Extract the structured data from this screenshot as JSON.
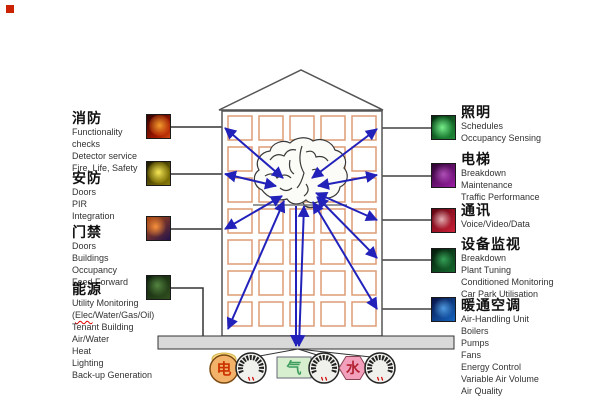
{
  "colors": {
    "arrow": "#2222bb",
    "window_frame": "#dd9c74",
    "corner_mark": "#cc2200"
  },
  "left_sections": [
    {
      "key": "fire",
      "icon": "fire-icon",
      "title": "消防",
      "lines": [
        "Functionality",
        "checks",
        "Detector service",
        "Fire, Life, Safety"
      ]
    },
    {
      "key": "security",
      "icon": "security-icon",
      "title": "安防",
      "lines": [
        "Doors",
        "PIR",
        "Integration"
      ]
    },
    {
      "key": "access",
      "icon": "access-control-icon",
      "title": "门禁",
      "lines": [
        "Doors",
        "Buildings",
        "Occupancy",
        "Feed Forward"
      ]
    },
    {
      "key": "energy",
      "icon": "energy-icon",
      "title": "能源",
      "squiggle_word": "Elec",
      "lines": [
        "Utility Monitoring",
        "(Elec/Water/Gas/Oil)",
        "Tenant Building",
        "Air/Water",
        "Heat",
        "Lighting",
        "Back-up Generation"
      ]
    }
  ],
  "right_sections": [
    {
      "key": "lighting",
      "icon": "lighting-icon",
      "title": "照明",
      "lines": [
        "Schedules",
        "Occupancy Sensing"
      ]
    },
    {
      "key": "elevator",
      "icon": "elevator-icon",
      "title": "电梯",
      "lines": [
        "Breakdown",
        "Maintenance",
        "Traffic Performance"
      ]
    },
    {
      "key": "comms",
      "icon": "communications-icon",
      "title": "通讯",
      "lines": [
        "Voice/Video/Data"
      ]
    },
    {
      "key": "monitor",
      "icon": "equipment-monitoring-icon",
      "title": "设备监视",
      "lines": [
        "Breakdown",
        "Plant Tuning",
        "Conditioned Monitoring",
        "Car Park Utilisation"
      ]
    },
    {
      "key": "hvac",
      "icon": "hvac-icon",
      "title": "暖通空调",
      "lines": [
        "Air-Handling Unit",
        "Boilers",
        "Pumps",
        "Fans",
        "Energy Control",
        "Variable Air Volume",
        "Air Quality"
      ]
    }
  ],
  "meters": [
    {
      "label": "电",
      "icon": "electricity-meter-icon",
      "shape": "circle"
    },
    {
      "label": "气",
      "icon": "gas-meter-icon",
      "shape": "rect"
    },
    {
      "label": "水",
      "icon": "water-meter-icon",
      "shape": "hexagon"
    }
  ]
}
